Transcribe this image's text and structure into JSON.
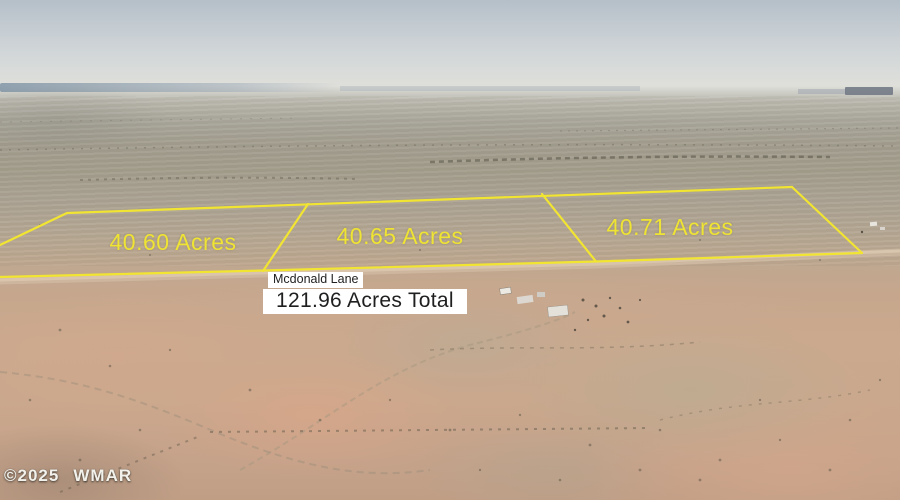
{
  "scene": {
    "kind": "aerial land-for-sale photo with parcel outlines",
    "road_label": "Mcdonald Lane",
    "total_label": "121.96 Acres Total"
  },
  "parcels": [
    {
      "label": "40.60 Acres",
      "acres": 40.6
    },
    {
      "label": "40.65 Acres",
      "acres": 40.65
    },
    {
      "label": "40.71 Acres",
      "acres": 40.71
    }
  ],
  "total_acres": 121.96,
  "watermark": {
    "year_text": "©2025",
    "brand_text": "WMAR"
  },
  "colors": {
    "boundary_yellow": "#f2e531",
    "acre_label_yellow": "#efe334",
    "annotation_box_bg": "#ffffff",
    "annotation_box_text": "#1f1f1f",
    "sky_top": "#b5bfc8",
    "haze": "#dfdfda",
    "plain_gray": "#a29d8e",
    "foreground_tan": "#c6a78d"
  },
  "boundaries": {
    "stroke_width": 2.2,
    "segments": [
      {
        "name": "top-line",
        "points": "67,213 792,187"
      },
      {
        "name": "left-edge",
        "points": "67,213 0,245"
      },
      {
        "name": "road-line",
        "points": "0,277 264,270.5 596,261.5 862,253"
      },
      {
        "name": "divider-1-2",
        "points": "308,204 263,271"
      },
      {
        "name": "divider-2-3",
        "points": "542,194 596,261.5"
      },
      {
        "name": "right-edge",
        "points": "792,187 862,253"
      }
    ]
  }
}
